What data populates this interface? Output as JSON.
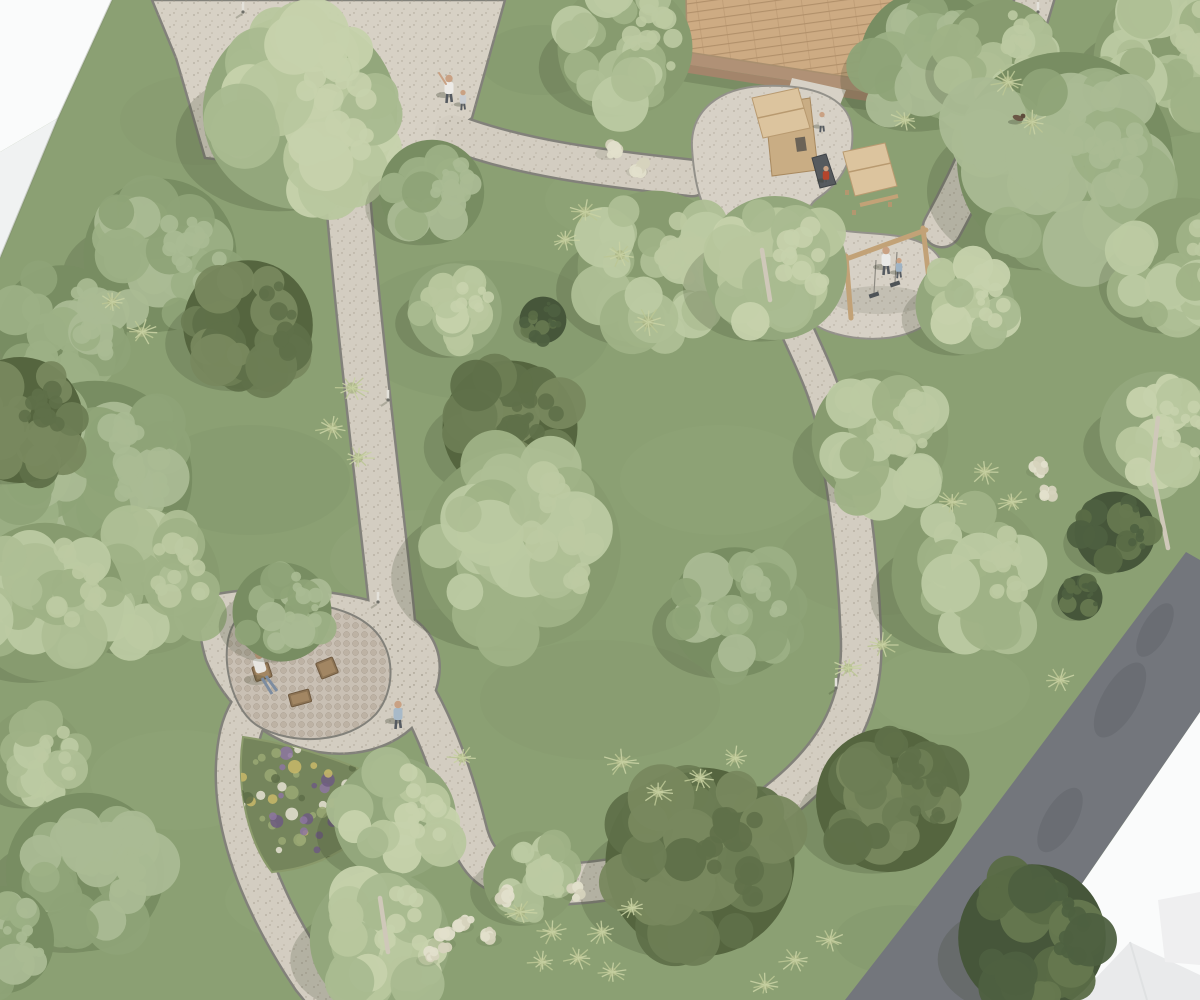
{
  "scene": {
    "label": "aerial-architectural-rendering-of-park-design",
    "canvas": {
      "w": 1200,
      "h": 1000
    },
    "grass": "#8ba073",
    "grass_dark_patches": [
      [
        480,
        330,
        260,
        140,
        0.1
      ],
      [
        250,
        480,
        200,
        110,
        0.1
      ],
      [
        600,
        700,
        240,
        120,
        0.08
      ],
      [
        880,
        560,
        200,
        110,
        0.08
      ],
      [
        200,
        120,
        160,
        90,
        0.08
      ],
      [
        540,
        60,
        120,
        70,
        0.12
      ],
      [
        900,
        940,
        130,
        70,
        0.1
      ]
    ],
    "grass_light_patches": [
      [
        420,
        560,
        180,
        100,
        0.12
      ],
      [
        720,
        480,
        200,
        110,
        0.1
      ],
      [
        180,
        780,
        180,
        100,
        0.1
      ],
      [
        620,
        200,
        150,
        80,
        0.1
      ],
      [
        950,
        690,
        160,
        90,
        0.1
      ],
      [
        300,
        900,
        150,
        80,
        0.08
      ]
    ]
  },
  "palette": {
    "gravel": "#d3cdc1",
    "gravel_light": "#d7d1c5",
    "edge": "#82817a",
    "sand": "#d7d1c6",
    "cobble": "#c9c0b4",
    "road": "#73767c",
    "road_dark": "#63666c",
    "white_face1": "#fafbfb",
    "white_face2": "#f0f2f2",
    "white_edge": "#e1e4e4",
    "wood": "#cdab83",
    "wood_line": "#b1906a",
    "wood_step1": "#b09176",
    "wood_step2": "#a3856b",
    "play_wood": "#c9ad84",
    "play_roof": "#dcc49e",
    "play_roof_line": "#b89a70",
    "play_post": "#b3976f",
    "slide": "#565a5e",
    "furniture": "#8d7454",
    "furniture_light": "#a78b66",
    "trunk": "#cfc8b9",
    "skin": "#c9a183",
    "pants": "#565b61",
    "shadow": "rgba(56,64,42,0.20)",
    "flowerbed_base": "#75855c",
    "flower_colors": [
      "#8d76a0",
      "#6d5a80",
      "#e6e2d2",
      "#c9b869",
      "#9aa873",
      "#5e6d48"
    ],
    "tuft_colors": [
      "#c9d2a4",
      "#bcc795"
    ],
    "tuft_core": "#a7b282",
    "plume": "#e2dfcb",
    "plume2": "#d6d3bd",
    "tree_palettes": {
      "L": {
        "base": "#879b6f",
        "blobs": [
          "#9fb286",
          "#aebf95",
          "#bccaa2"
        ]
      },
      "M": {
        "base": "#788d62",
        "blobs": [
          "#8ea377",
          "#9cb085",
          "#aabb93"
        ]
      },
      "B": {
        "base": "#93a77c",
        "blobs": [
          "#a9ba90",
          "#b8c79e",
          "#c6d2ac"
        ]
      },
      "D": {
        "base": "#55653f",
        "blobs": [
          "#6d7d54",
          "#78885e",
          "#5f7049"
        ]
      },
      "K": {
        "base": "#46563a",
        "blobs": [
          "#5a6c46",
          "#66784f",
          "#4e6040"
        ]
      }
    }
  },
  "building_topleft": {
    "face1": "0,0 112,0 58,118 0,152",
    "face2": "0,152 58,118 0,258",
    "edge_line": "112,0 58,118 0,258"
  },
  "road": {
    "poly": "1186,552 1090,680 985,820 845,1000 1002,1000 1105,850 1200,712 1200,560",
    "blotches": [
      [
        1120,
        700,
        42,
        18
      ],
      [
        1060,
        820,
        36,
        16
      ],
      [
        1005,
        930,
        30,
        14
      ],
      [
        1155,
        630,
        30,
        13
      ]
    ]
  },
  "white_bottomright": {
    "poly": "1200,712 1002,1000 1200,1000",
    "roof1": "1075,1000 1130,942 1200,975 1200,1000",
    "roof1_ridge": "1130,942 1147,1000",
    "roof2": "1158,900 1200,892 1200,965 1165,962"
  },
  "plaza": {
    "poly": "152,0 505,0 472,118 420,156 342,173 205,158 176,58"
  },
  "junction_pad": "M200,598 C250,584 330,586 388,606 C430,620 448,652 436,690 C420,740 368,760 318,752 C260,742 222,700 206,660 C200,640 196,612 200,598 Z",
  "paths": [
    {
      "name": "path-plaza-to-seating",
      "d": "M345,158 C352,260 368,400 384,540 S390,610 390,628",
      "w": 42
    },
    {
      "name": "path-seating-to-south",
      "d": "M392,640 C330,650 255,672 240,735 C226,800 248,882 312,978 L330,1000",
      "w": 38
    },
    {
      "name": "path-seating-to-junction",
      "d": "M388,655 C425,695 452,768 468,832 C476,862 492,878 530,882",
      "w": 36
    },
    {
      "name": "path-junction-to-playground",
      "d": "M528,884 C625,888 702,862 778,802 C842,752 864,700 861,636 C858,556 848,486 837,432",
      "w": 38
    },
    {
      "name": "path-playground-link",
      "d": "M836,440 C828,392 810,360 797,330",
      "w": 30
    },
    {
      "name": "path-plaza-to-playground",
      "d": "M452,132 C520,158 600,168 692,178",
      "w": 34
    },
    {
      "name": "path-playground-to-northeast",
      "d": "M942,228 C985,150 1012,75 1036,-6",
      "w": 36
    }
  ],
  "deck": {
    "poly": "686,-10 940,-45 893,84 687,52",
    "shadow": "680,60 886,92 878,112 674,80",
    "step1": "687,52 893,84 889,96 684,64",
    "step2": "684,64 889,96 886,104 682,72"
  },
  "playground": {
    "sand": "M692,148 C690,110 720,88 762,86 C810,84 848,96 852,128 C855,158 842,182 818,198 C808,205 806,214 816,222 C840,238 890,228 922,243 C950,256 952,290 938,312 C920,340 868,345 830,332 C800,322 798,300 780,272 C770,256 748,244 724,230 C700,216 694,180 692,148 Z",
    "neck": "792,78 846,90 838,110 786,98",
    "tower1": {
      "floor": "765,105 810,98 818,170 772,176",
      "roof": "752,98 798,88 810,128 763,138",
      "ridge": "758,118 804,108",
      "door": [
        795,
        138,
        10,
        14
      ],
      "slide": "812,158 826,154 836,184 820,188"
    },
    "tower2": {
      "roof": "843,152 885,143 897,186 855,196",
      "ridge": "849,172 891,163",
      "posts": [
        [
          845,
          190
        ],
        [
          880,
          183
        ],
        [
          852,
          210
        ],
        [
          888,
          202
        ]
      ],
      "bench": "860,205 898,196"
    },
    "swing": {
      "left_post": "846,256 851,318",
      "beam": "849,258 926,230",
      "right_post": "923,228 930,288",
      "ropes": [
        [
          876,
          260,
          874,
          293
        ],
        [
          897,
          252,
          895,
          282
        ]
      ],
      "seats": [
        [
          874,
          295
        ],
        [
          895,
          284
        ]
      ]
    }
  },
  "seating": {
    "pad": "M238,618 C278,596 342,600 372,628 C396,650 396,690 376,714 C348,744 292,746 258,726 C228,708 216,642 238,618 Z",
    "chair_with_person": {
      "x": 262,
      "y": 672,
      "w": 17,
      "h": 15,
      "rot": -18
    },
    "armchair": {
      "x": 327,
      "y": 668,
      "w": 18,
      "h": 17,
      "rot": -22
    },
    "table": {
      "x": 300,
      "y": 698,
      "w": 21,
      "h": 13,
      "rot": -15
    }
  },
  "flowerbed": {
    "blob": "M243,737 C300,745 360,765 400,790 C380,830 330,868 272,872 C250,845 235,790 243,737 Z",
    "cx": 315,
    "cy": 800,
    "rx": 82,
    "ry": 62,
    "dots": 70
  },
  "trees": [
    {
      "x": 625,
      "y": 48,
      "r": 75,
      "t": "L"
    },
    {
      "x": 930,
      "y": 60,
      "r": 78,
      "t": "M"
    },
    {
      "x": 1000,
      "y": 58,
      "r": 65,
      "t": "L"
    },
    {
      "x": 1170,
      "y": 60,
      "r": 85,
      "t": "L"
    },
    {
      "x": 1065,
      "y": 160,
      "r": 120,
      "t": "M"
    },
    {
      "x": 300,
      "y": 112,
      "r": 108,
      "t": "B"
    },
    {
      "x": 432,
      "y": 192,
      "r": 58,
      "t": "M"
    },
    {
      "x": 160,
      "y": 255,
      "r": 85,
      "t": "M"
    },
    {
      "x": 1185,
      "y": 265,
      "r": 75,
      "t": "L"
    },
    {
      "x": 965,
      "y": 305,
      "r": 55,
      "t": "B"
    },
    {
      "x": 655,
      "y": 268,
      "r": 86,
      "t": "L"
    },
    {
      "x": 775,
      "y": 268,
      "r": 80,
      "t": "B",
      "trunk": "M770,300 L762,250"
    },
    {
      "x": 455,
      "y": 310,
      "r": 52,
      "t": "B"
    },
    {
      "x": 543,
      "y": 320,
      "r": 26,
      "t": "K"
    },
    {
      "x": 62,
      "y": 330,
      "r": 72,
      "t": "M"
    },
    {
      "x": 248,
      "y": 325,
      "r": 72,
      "t": "D"
    },
    {
      "x": 880,
      "y": 438,
      "r": 76,
      "t": "L"
    },
    {
      "x": 510,
      "y": 428,
      "r": 75,
      "t": "D"
    },
    {
      "x": 1158,
      "y": 430,
      "r": 65,
      "t": "B",
      "trunk": "M1168,548 L1152,470 L1158,418"
    },
    {
      "x": 1115,
      "y": 532,
      "r": 45,
      "t": "K"
    },
    {
      "x": 1080,
      "y": 598,
      "r": 25,
      "t": "K"
    },
    {
      "x": 95,
      "y": 478,
      "r": 108,
      "t": "M"
    },
    {
      "x": 20,
      "y": 420,
      "r": 70,
      "t": "D"
    },
    {
      "x": 968,
      "y": 575,
      "r": 85,
      "t": "L"
    },
    {
      "x": 520,
      "y": 548,
      "r": 112,
      "t": "L"
    },
    {
      "x": 735,
      "y": 612,
      "r": 72,
      "t": "M"
    },
    {
      "x": 148,
      "y": 582,
      "r": 80,
      "t": "L"
    },
    {
      "x": 45,
      "y": 602,
      "r": 88,
      "t": "L"
    },
    {
      "x": 282,
      "y": 612,
      "r": 55,
      "t": "M"
    },
    {
      "x": 35,
      "y": 758,
      "r": 55,
      "t": "L"
    },
    {
      "x": 888,
      "y": 800,
      "r": 80,
      "t": "D"
    },
    {
      "x": 700,
      "y": 862,
      "r": 105,
      "t": "D"
    },
    {
      "x": 85,
      "y": 872,
      "r": 88,
      "t": "M"
    },
    {
      "x": 395,
      "y": 818,
      "r": 68,
      "t": "B"
    },
    {
      "x": 530,
      "y": 878,
      "r": 52,
      "t": "L"
    },
    {
      "x": 0,
      "y": 940,
      "r": 60,
      "t": "M"
    },
    {
      "x": 380,
      "y": 940,
      "r": 78,
      "t": "B",
      "trunk": "M388,952 L380,898"
    },
    {
      "x": 1032,
      "y": 938,
      "r": 82,
      "t": "K"
    }
  ],
  "tufts": [
    [
      352,
      388,
      16
    ],
    [
      332,
      428,
      15
    ],
    [
      358,
      458,
      14
    ],
    [
      585,
      212,
      15
    ],
    [
      565,
      240,
      13
    ],
    [
      620,
      255,
      14
    ],
    [
      648,
      322,
      16
    ],
    [
      1008,
      82,
      16
    ],
    [
      1032,
      122,
      14
    ],
    [
      142,
      332,
      14
    ],
    [
      112,
      302,
      13
    ],
    [
      985,
      472,
      15
    ],
    [
      1012,
      502,
      14
    ],
    [
      952,
      502,
      13
    ],
    [
      622,
      762,
      16
    ],
    [
      658,
      792,
      15
    ],
    [
      700,
      778,
      14
    ],
    [
      735,
      758,
      13
    ],
    [
      462,
      758,
      13
    ],
    [
      882,
      645,
      14
    ],
    [
      848,
      668,
      13
    ],
    [
      520,
      912,
      15
    ],
    [
      552,
      932,
      14
    ],
    [
      578,
      958,
      13
    ],
    [
      542,
      962,
      13
    ],
    [
      602,
      932,
      14
    ],
    [
      612,
      972,
      13
    ],
    [
      632,
      908,
      13
    ],
    [
      795,
      960,
      14
    ],
    [
      830,
      940,
      13
    ],
    [
      765,
      985,
      13
    ],
    [
      1060,
      680,
      13
    ],
    [
      905,
      120,
      13
    ]
  ],
  "plumes": [
    [
      445,
      940,
      14
    ],
    [
      465,
      923,
      12
    ],
    [
      492,
      936,
      13
    ],
    [
      430,
      957,
      11
    ],
    [
      505,
      897,
      12
    ],
    [
      610,
      150,
      12
    ],
    [
      640,
      168,
      11
    ],
    [
      575,
      892,
      10
    ],
    [
      1040,
      468,
      11
    ],
    [
      1048,
      492,
      10
    ]
  ],
  "bollards": [
    [
      243,
      12
    ],
    [
      388,
      400
    ],
    [
      378,
      602
    ],
    [
      340,
      914
    ],
    [
      1038,
      12
    ],
    [
      836,
      688
    ]
  ],
  "people": [
    {
      "kind": "adult",
      "x": 449,
      "y": 86,
      "shirt": "#eceae6",
      "wave": true,
      "name": "person-adult-plaza"
    },
    {
      "kind": "child",
      "x": 463,
      "y": 98,
      "shirt": "#c9cdd2",
      "name": "person-child-plaza"
    },
    {
      "kind": "adult",
      "x": 398,
      "y": 712,
      "shirt": "#a8bac9",
      "name": "person-walking-path"
    },
    {
      "kind": "adult",
      "x": 886,
      "y": 258,
      "shirt": "#e9e9e7",
      "name": "person-adult-swing"
    },
    {
      "kind": "child",
      "x": 899,
      "y": 266,
      "shirt": "#9fb3c4",
      "name": "person-child-swing"
    },
    {
      "kind": "child",
      "x": 826,
      "y": 174,
      "shirt": "#b5452c",
      "name": "person-child-tower"
    },
    {
      "kind": "child",
      "x": 822,
      "y": 120,
      "shirt": "#d9d4ca",
      "name": "person-child-platform"
    }
  ],
  "dog": {
    "x": 1018,
    "y": 118
  }
}
